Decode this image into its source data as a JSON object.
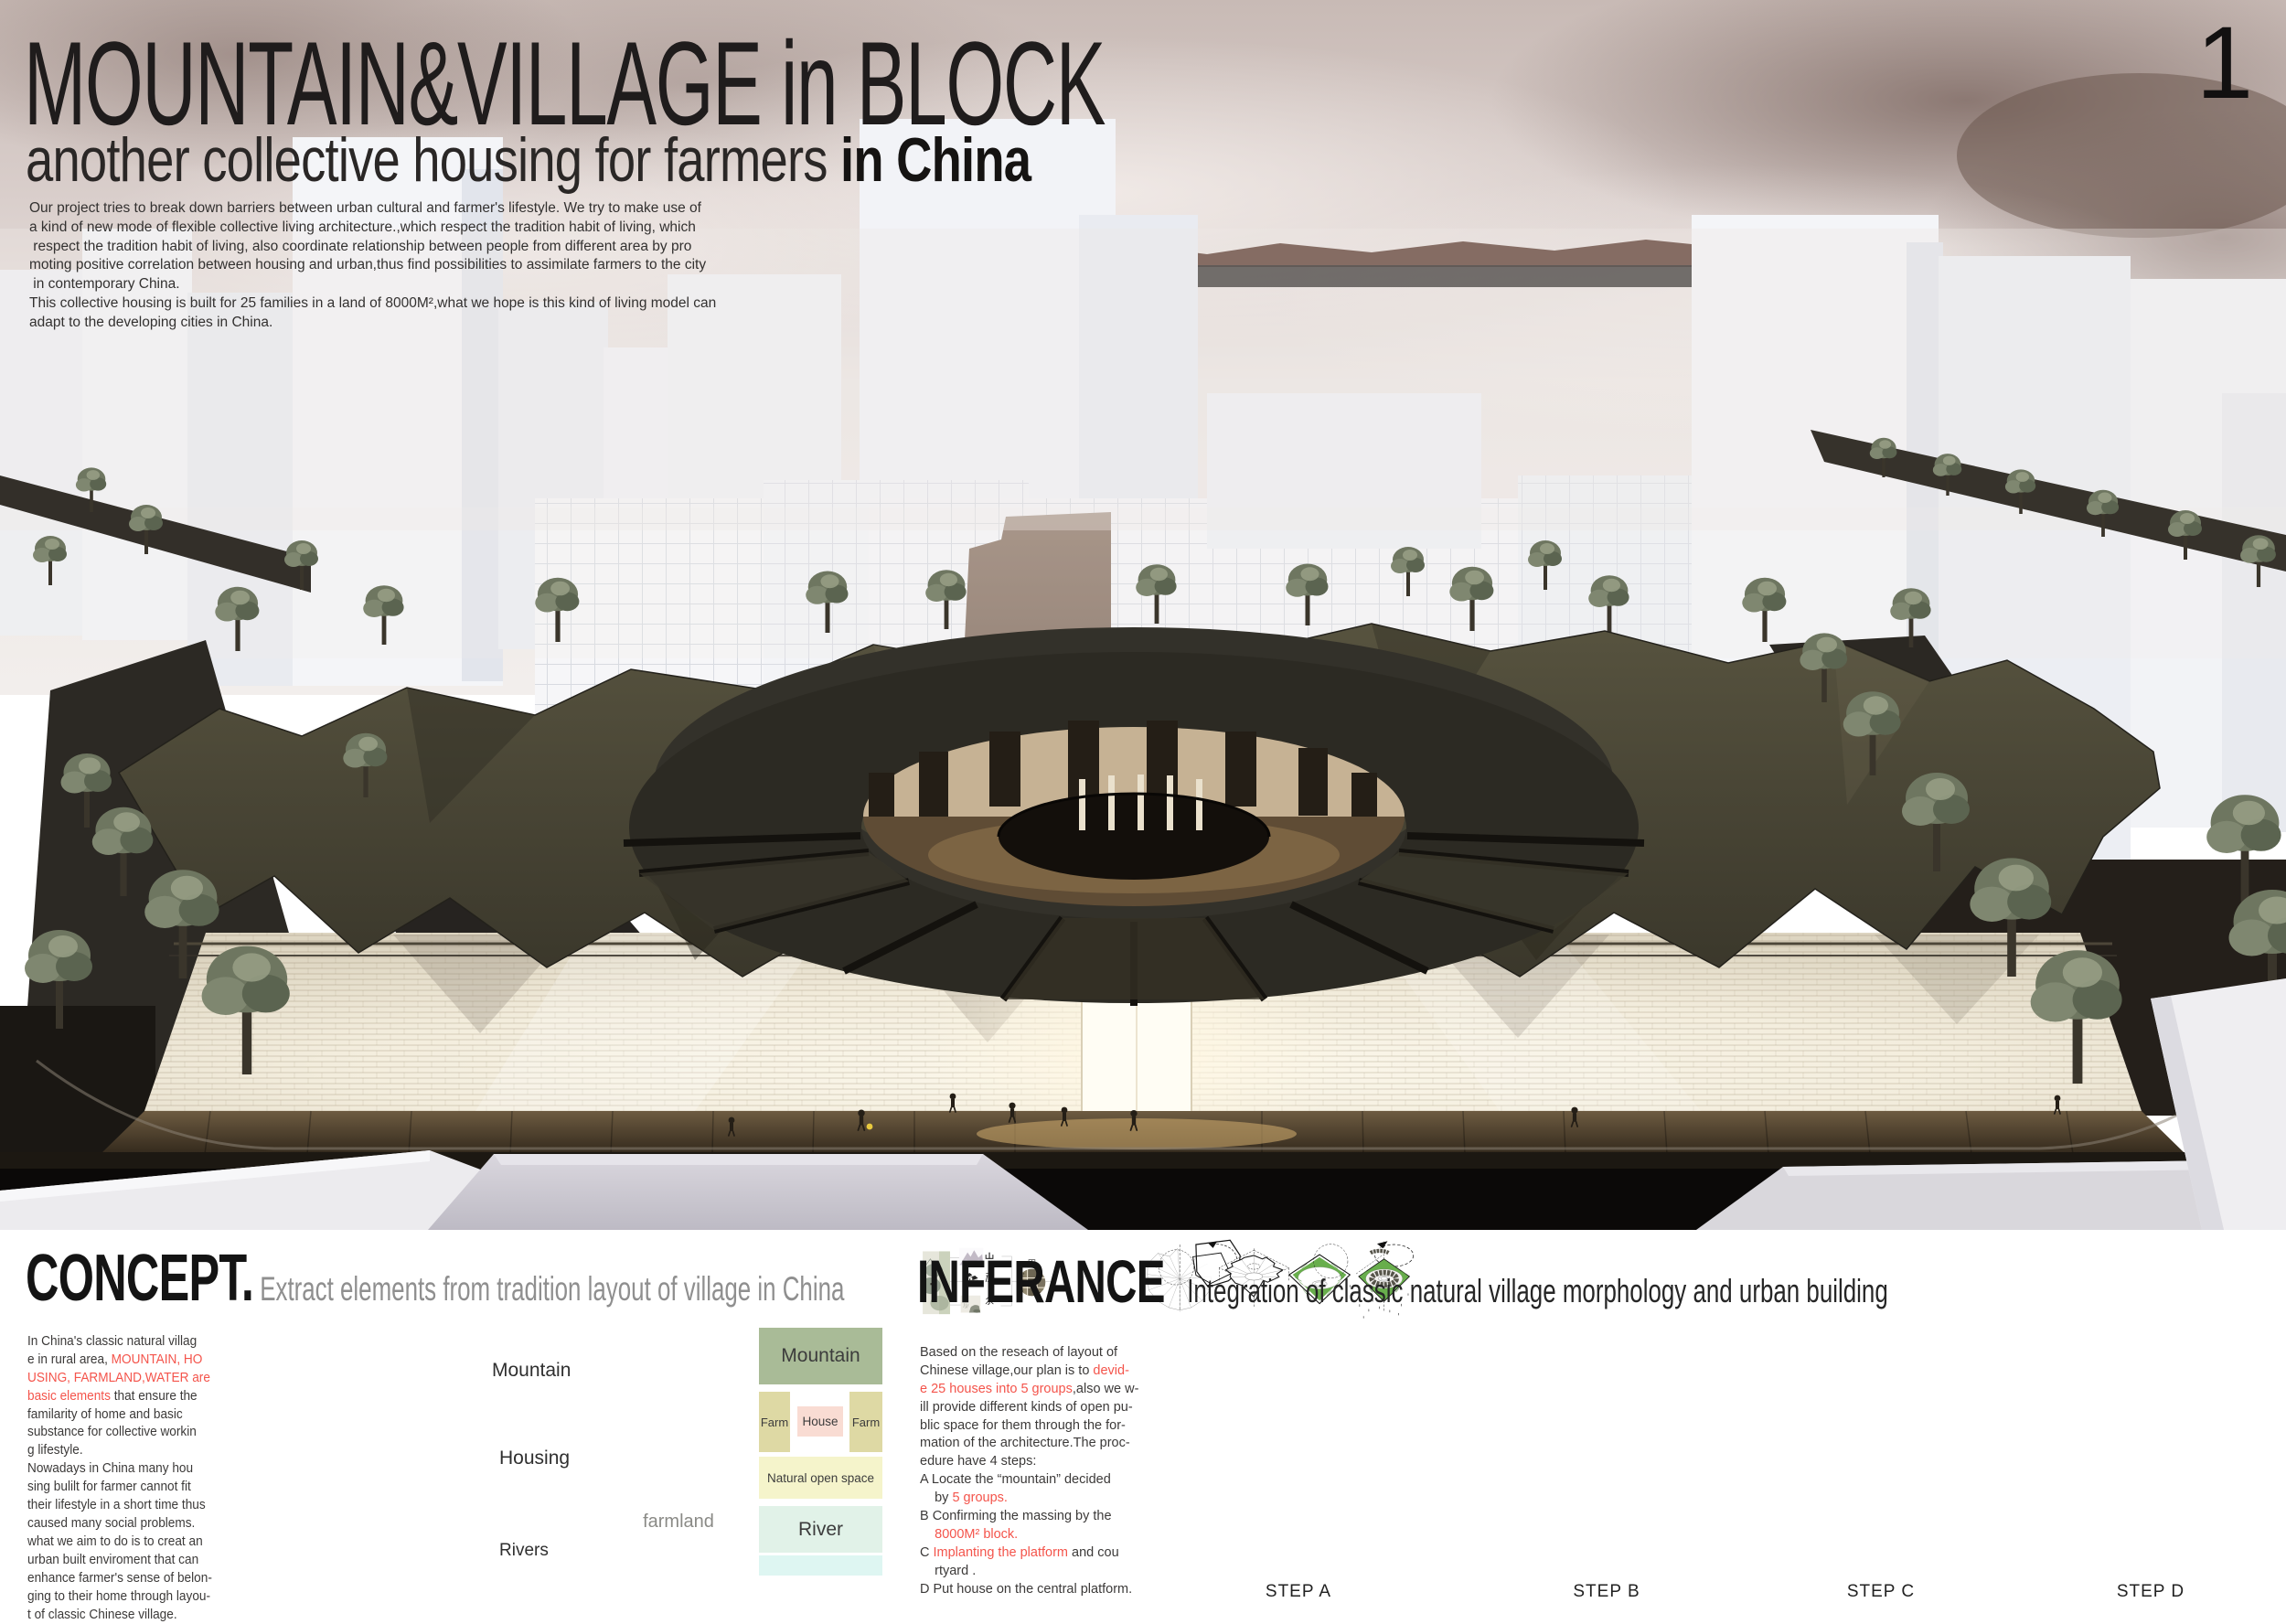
{
  "page": {
    "number": "1"
  },
  "colors": {
    "accent_red": "#f4544b",
    "step_green": "#68ae4c",
    "step_house_gray": "#56544a",
    "block_mountain": "#a9bb97",
    "block_farm": "#ded9a4",
    "block_house": "#f9dcd3",
    "block_open_space": "#f5f4cb",
    "block_river": "#e1f2e8",
    "block_river_light": "#def6f2"
  },
  "header": {
    "title": "MOUNTAIN&VILLAGE in BLOCK",
    "subtitle": "another collective housing for farmers ",
    "subtitle_emphasis": "in China",
    "intro": "Our project tries to break down barriers between urban cultural and farmer's lifestyle. We try to make use of\na kind of new mode of flexible collective living architecture.,which respect the tradition habit of living, which\n respect the tradition habit of living, also coordinate relationship between people from different area by pro\nmoting positive correlation between housing and urban,thus find possibilities to assimilate farmers to the city\n in contemporary China.\nThis collective housing is built for 25 families in a land of 8000M²,what we hope is this kind of living model can\nadapt to the developing cities in China."
  },
  "concept": {
    "heading": "CONCEPT.",
    "subheading": "Extract elements from tradition layout of village in China",
    "body": {
      "s1": "In China's classic natural villag\ne in rural area, ",
      "s2_red": "MOUNTAIN, HO\nUSING, FARMLAND,WATER are\nbasic elements ",
      "s3": "that ensure the\nfamilarity of home and basic\nsubstance for collective workin\ng lifestyle.\nNowadays  in China many hou\nsing bulilt for farmer cannot fit\ntheir lifestyle in a short time thus\ncaused many social problems.\nwhat we aim to do is to creat an\nurban built enviroment that can\nenhance farmer's sense of belon-\nging to their home through layou-\nt of classic Chinese village."
    },
    "elements": [
      {
        "char": "山",
        "label": "Mountain"
      },
      {
        "char": "屋",
        "label": "Housing"
      },
      {
        "char": "水",
        "label": "Rivers"
      }
    ],
    "farmland": {
      "char": "田",
      "label": "farmland"
    },
    "blocks": {
      "mountain": "Mountain",
      "farm_left": "Farm",
      "house": "House",
      "farm_right": "Farm",
      "open_space": "Natural open space",
      "river": "River"
    }
  },
  "inference": {
    "heading": "INFERANCE",
    "subheading": "Integration of classic natural village morphology and urban building",
    "body": {
      "s1": "Based on the reseach of layout of\nChinese village,our plan is to ",
      "s2_red": "devid-\ne 25 houses into 5 groups",
      "s3": ",also we w-\nill provide different kinds of open pu-\nblic space for them through the for-\nmation of the architecture.The proc-\nedure have 4 steps:\nA Locate the “mountain” decided\n    by ",
      "s4_red": "5 groups.",
      "s5": "\nB  Confirming the massing by the\n    ",
      "s6_red": "8000M² block.",
      "s7": "\nC  ",
      "s8_red": "Implanting the platform",
      "s9": " and cou\n    rtyard .\nD  Put house on the central platform."
    },
    "steps": [
      {
        "label": "STEP A"
      },
      {
        "label": "STEP B"
      },
      {
        "label": "STEP C"
      },
      {
        "label": "STEP D"
      }
    ]
  }
}
